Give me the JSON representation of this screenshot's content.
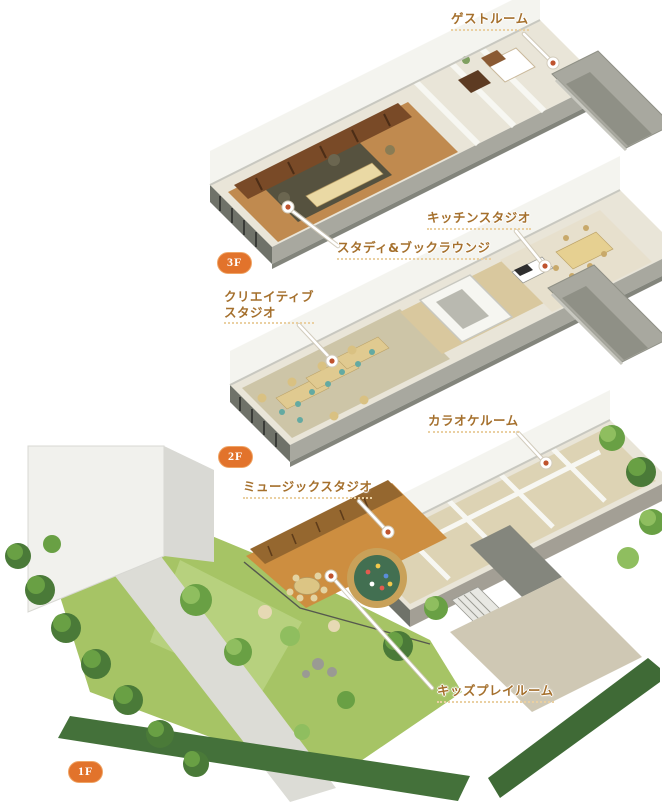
{
  "palette": {
    "label_text": "#a5702d",
    "label_underline": "#ead0a2",
    "badge_background": "#e2732b",
    "badge_text": "#ffffff",
    "marker_dot": "#bf532e",
    "leader_line": "#ffffff"
  },
  "floor_plan": {
    "badges": [
      {
        "label": "3F",
        "x": 217,
        "y": 252
      },
      {
        "label": "2F",
        "x": 218,
        "y": 446
      },
      {
        "label": "1F",
        "x": 68,
        "y": 761
      }
    ],
    "floors": [
      {
        "badge": "3F",
        "rooms": [
          "ゲストルーム",
          "スタディ&ブックラウンジ"
        ]
      },
      {
        "badge": "2F",
        "rooms": [
          "キッチンスタジオ",
          "クリエイティブスタジオ"
        ]
      },
      {
        "badge": "1F",
        "rooms": [
          "カラオケルーム",
          "ミュージックスタジオ",
          "キッズプレイルーム"
        ]
      }
    ],
    "callouts": [
      {
        "id": "guest-room",
        "room": "ゲストルーム",
        "floor": "3F",
        "label": {
          "lines": [
            "ゲストルーム"
          ],
          "x": 451,
          "y": 11
        },
        "marker": {
          "x": 553,
          "y": 63
        },
        "leader": [
          [
            524,
            34
          ],
          [
            550,
            60
          ]
        ]
      },
      {
        "id": "study-book-lounge",
        "room": "スタディ&ブックラウンジ",
        "floor": "3F",
        "label": {
          "lines": [
            "スタディ&ブックラウンジ"
          ],
          "x": 337,
          "y": 240
        },
        "marker": {
          "x": 288,
          "y": 207
        },
        "leader": [
          [
            291,
            210
          ],
          [
            338,
            246
          ]
        ]
      },
      {
        "id": "kitchen-studio",
        "room": "キッチンスタジオ",
        "floor": "2F",
        "label": {
          "lines": [
            "キッチンスタジオ"
          ],
          "x": 427,
          "y": 210
        },
        "marker": {
          "x": 545,
          "y": 266
        },
        "leader": [
          [
            516,
            231
          ],
          [
            542,
            263
          ]
        ]
      },
      {
        "id": "creative-studio",
        "room": "クリエイティブスタジオ",
        "floor": "2F",
        "label": {
          "lines": [
            "クリエイティブ",
            "スタジオ"
          ],
          "x": 224,
          "y": 289
        },
        "marker": {
          "x": 332,
          "y": 361
        },
        "leader": [
          [
            299,
            325
          ],
          [
            330,
            358
          ]
        ]
      },
      {
        "id": "karaoke-room",
        "room": "カラオケルーム",
        "floor": "1F",
        "label": {
          "lines": [
            "カラオケルーム"
          ],
          "x": 428,
          "y": 413
        },
        "marker": {
          "x": 546,
          "y": 463
        },
        "leader": [
          [
            518,
            433
          ],
          [
            543,
            460
          ]
        ]
      },
      {
        "id": "music-studio",
        "room": "ミュージックスタジオ",
        "floor": "1F",
        "label": {
          "lines": [
            "ミュージックスタジオ"
          ],
          "x": 243,
          "y": 479
        },
        "marker": {
          "x": 388,
          "y": 532
        },
        "leader": [
          [
            359,
            501
          ],
          [
            385,
            529
          ]
        ]
      },
      {
        "id": "kids-play-room",
        "room": "キッズプレイルーム",
        "floor": "1F",
        "label": {
          "lines": [
            "キッズプレイルーム"
          ],
          "x": 437,
          "y": 683
        },
        "marker": {
          "x": 331,
          "y": 576
        },
        "leader": [
          [
            334,
            579
          ],
          [
            432,
            688
          ]
        ]
      }
    ]
  }
}
